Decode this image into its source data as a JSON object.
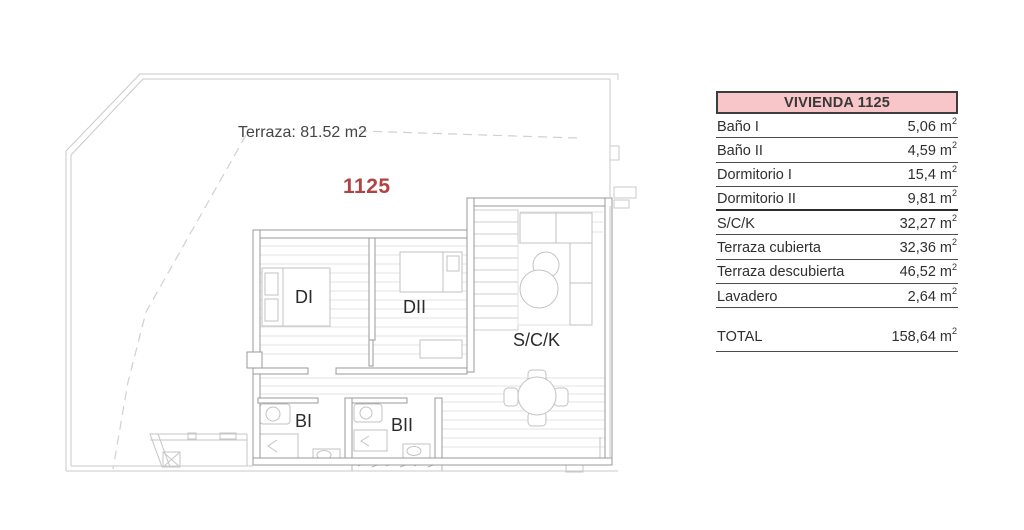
{
  "plan": {
    "terrace_label": "Terraza: 81.52 m2",
    "unit_number": "1125",
    "unit_number_color": "#b24343",
    "room_labels": {
      "di": "DI",
      "dii": "DII",
      "sck": "S/C/K",
      "bi": "BI",
      "bii": "BII"
    }
  },
  "table": {
    "title": "VIVIENDA 1125",
    "header_bg": "#f8c6c9",
    "unit": "m",
    "unit_sup": "2",
    "rows": [
      {
        "label": "Baño I",
        "value": "5,06"
      },
      {
        "label": "Baño II",
        "value": "4,59"
      },
      {
        "label": "Dormitorio I",
        "value": "15,4"
      },
      {
        "label": "Dormitorio II",
        "value": "9,81"
      },
      {
        "label": "S/C/K",
        "value": "32,27"
      },
      {
        "label": "Terraza cubierta",
        "value": "32,36"
      },
      {
        "label": "Terraza descubierta",
        "value": "46,52"
      },
      {
        "label": "Lavadero",
        "value": "2,64"
      }
    ],
    "total": {
      "label": "TOTAL",
      "value": "158,64"
    }
  }
}
